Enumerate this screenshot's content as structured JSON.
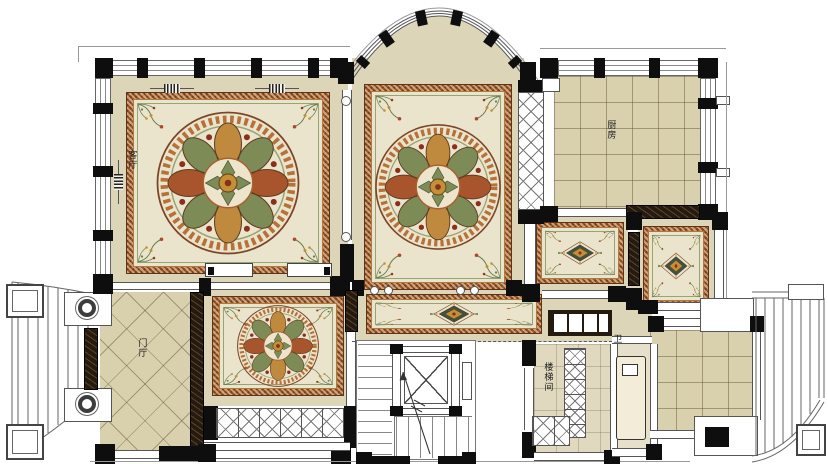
{
  "palette": {
    "floor_beige": "#DDD5B8",
    "tile_tan": "#D9D0AE",
    "rug_cream": "#EBE4CD",
    "rug_rust": "#9C5527",
    "marble_dark": "#241A10",
    "wall_black": "#0E0E0E",
    "foliage_green": "#7D8B57",
    "gold": "#C49035",
    "accent_red": "#8A2F1E"
  },
  "rooms": {
    "living": {
      "label": "客厅"
    },
    "kitchen": {
      "label": "厨房"
    },
    "entry": {
      "label": "门厅"
    },
    "stairwell": {
      "label": "楼梯间"
    },
    "bath": {
      "label": "卫"
    }
  }
}
